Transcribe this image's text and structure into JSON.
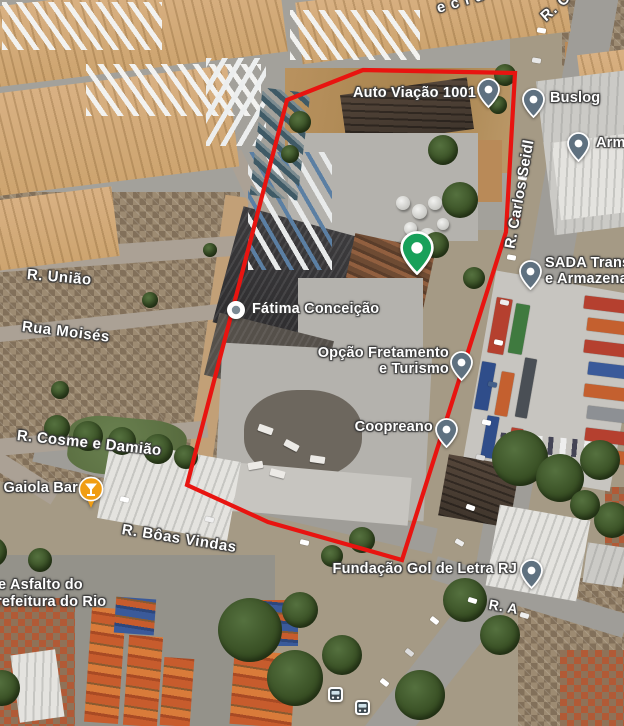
{
  "map": {
    "boundary": {
      "color": "#e81410",
      "points": "287,100 363,70 515,73 506,232 402,560 268,522 187,485"
    },
    "street_labels": [
      {
        "text": "ecida",
        "x": 437,
        "y": 0,
        "rot": -16,
        "size": 15,
        "spacing": 6
      },
      {
        "text": "R. C",
        "x": 543,
        "y": 10,
        "rot": -42,
        "size": 15,
        "spacing": 1
      },
      {
        "text": "R. Carlos Seidl",
        "x": 510,
        "y": 240,
        "rot": -80,
        "size": 15,
        "spacing": 0.3
      },
      {
        "text": "R. União",
        "x": 27,
        "y": 266,
        "rot": 5,
        "size": 15,
        "spacing": 0.5
      },
      {
        "text": "Rua Moisés",
        "x": 22,
        "y": 318,
        "rot": 7,
        "size": 15,
        "spacing": 0.5
      },
      {
        "text": "R. Cosme e Damião",
        "x": 17,
        "y": 427,
        "rot": 6,
        "size": 15,
        "spacing": 0.3
      },
      {
        "text": "R. Bôas Vindas",
        "x": 122,
        "y": 521,
        "rot": 9,
        "size": 15,
        "spacing": 0.5
      },
      {
        "text": "e Asfalto do",
        "x": -2,
        "y": 577,
        "rot": 0,
        "size": 14.5,
        "spacing": 0.2
      },
      {
        "text": "refeitura do Rio",
        "x": -4,
        "y": 594,
        "rot": 0,
        "size": 14.5,
        "spacing": 0.2
      },
      {
        "text": "R. A",
        "x": 489,
        "y": 596,
        "rot": 10,
        "size": 14,
        "spacing": 0.5
      }
    ],
    "pois": [
      {
        "id": "auto-viacao-1001",
        "label": "Auto Viação 1001",
        "label2": "",
        "marker": "pin",
        "mx": 488,
        "my": 89,
        "label_side": "left",
        "lx": 476,
        "ly": 86
      },
      {
        "id": "buslog",
        "label": "Buslog",
        "label2": "",
        "marker": "pin",
        "mx": 533,
        "my": 99,
        "label_side": "right",
        "lx": 550,
        "ly": 91
      },
      {
        "id": "armazem",
        "label": "Arma",
        "label2": "",
        "marker": "pin",
        "mx": 578,
        "my": 143,
        "label_side": "right",
        "lx": 596,
        "ly": 136
      },
      {
        "id": "sada-transportes",
        "label": "SADA Transp",
        "label2": "e Armazenag",
        "marker": "pin",
        "mx": 530,
        "my": 271,
        "label_side": "right",
        "lx": 545,
        "ly": 256
      },
      {
        "id": "fatima-conceicao",
        "label": "Fátima Conceição",
        "label2": "",
        "marker": "dot",
        "mx": 236,
        "my": 310,
        "label_side": "right",
        "lx": 252,
        "ly": 302
      },
      {
        "id": "opcao-fretamento",
        "label": "Opção Fretamento",
        "label2": "e Turismo",
        "marker": "pin",
        "mx": 461,
        "my": 362,
        "label_side": "left",
        "lx": 449,
        "ly": 346
      },
      {
        "id": "coopreano",
        "label": "Coopreano",
        "label2": "",
        "marker": "pin",
        "mx": 446,
        "my": 429,
        "label_side": "left",
        "lx": 433,
        "ly": 420
      },
      {
        "id": "fundacao-gol-de-letra",
        "label": "Fundação Gol de Letra RJ",
        "label2": "",
        "marker": "pin",
        "mx": 531,
        "my": 570,
        "label_side": "left",
        "lx": 517,
        "ly": 562
      },
      {
        "id": "gaiola-bar",
        "label": "Gaiola Bar",
        "label2": "",
        "marker": "drink",
        "mx": 91,
        "my": 489,
        "label_side": "left",
        "lx": 78,
        "ly": 481
      },
      {
        "id": "green-place",
        "label": "",
        "label2": "",
        "marker": "green",
        "mx": 417,
        "my": 248,
        "label_side": "none",
        "lx": 0,
        "ly": 0
      }
    ],
    "transit_stops": [
      {
        "id": "bus-stop-1",
        "x": 335,
        "y": 694
      },
      {
        "id": "bus-stop-2",
        "x": 362,
        "y": 707
      }
    ],
    "marker_colors": {
      "pin": "#5f7180",
      "green_place": "#18a05a",
      "bar_orange": "#f09d13",
      "dot_center": "#7b8a94",
      "transit_dark": "#3e4a52"
    }
  }
}
